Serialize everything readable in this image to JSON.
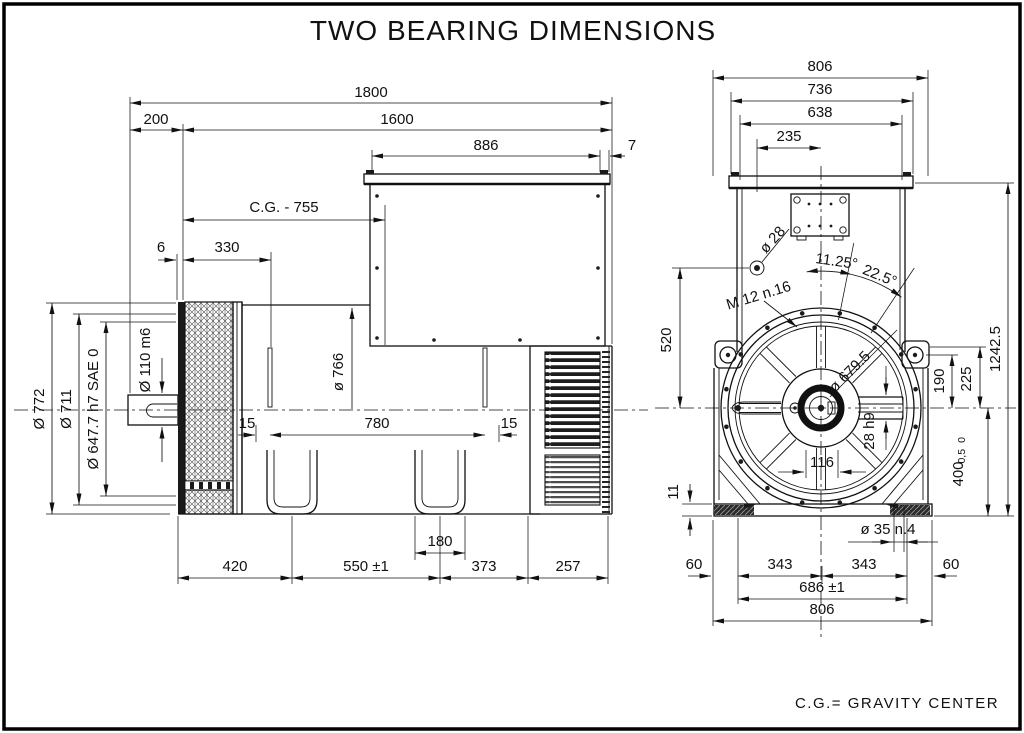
{
  "title": "TWO BEARING DIMENSIONS",
  "legend": "C.G.= GRAVITY CENTER",
  "side": {
    "overall_length": "1800",
    "shaft_extension": "200",
    "frame_length": "1600",
    "terminal_box_width": "886",
    "rear_gap": "7",
    "gravity_center": "C.G.  -  755",
    "adapter_gap": "6",
    "bracket_length": "330",
    "frame_diameter": "ø 766",
    "key_left": "15",
    "bolt_span": "780",
    "key_right": "15",
    "dia_outer": "Ø 772",
    "dia_frame": "Ø 711",
    "dia_flange": "Ø 647.7  h7  SAE 0",
    "dia_shaft": "Ø 110  m6",
    "foot_a": "420",
    "foot_b": "550 ±1",
    "slot_width": "180",
    "foot_c": "373",
    "foot_d": "257"
  },
  "end": {
    "width_overall_top": "806",
    "width_cap": "736",
    "width_body": "638",
    "width_gland": "235",
    "lift_hole": "ø 28",
    "thread_holes": "M 12  n.16",
    "angle_half": "11.25°",
    "angle_full": "22.5°",
    "hole_height": "520",
    "bolt_circle": "ø 679.5",
    "hub_width": "116",
    "key_section": "28 h9",
    "ear_height": "190",
    "ear_top_height": "225",
    "height_overall": "1242.5",
    "shaft_height": "400",
    "shaft_height_tol_hi": "0",
    "shaft_height_tol_lo": "-0,5",
    "pad_height": "11",
    "foot_hole": "ø 35  n.4",
    "edge_left": "60",
    "half_span_left": "343",
    "half_span_right": "343",
    "edge_right": "60",
    "foot_span": "686 ±1",
    "width_overall_bottom": "806"
  }
}
